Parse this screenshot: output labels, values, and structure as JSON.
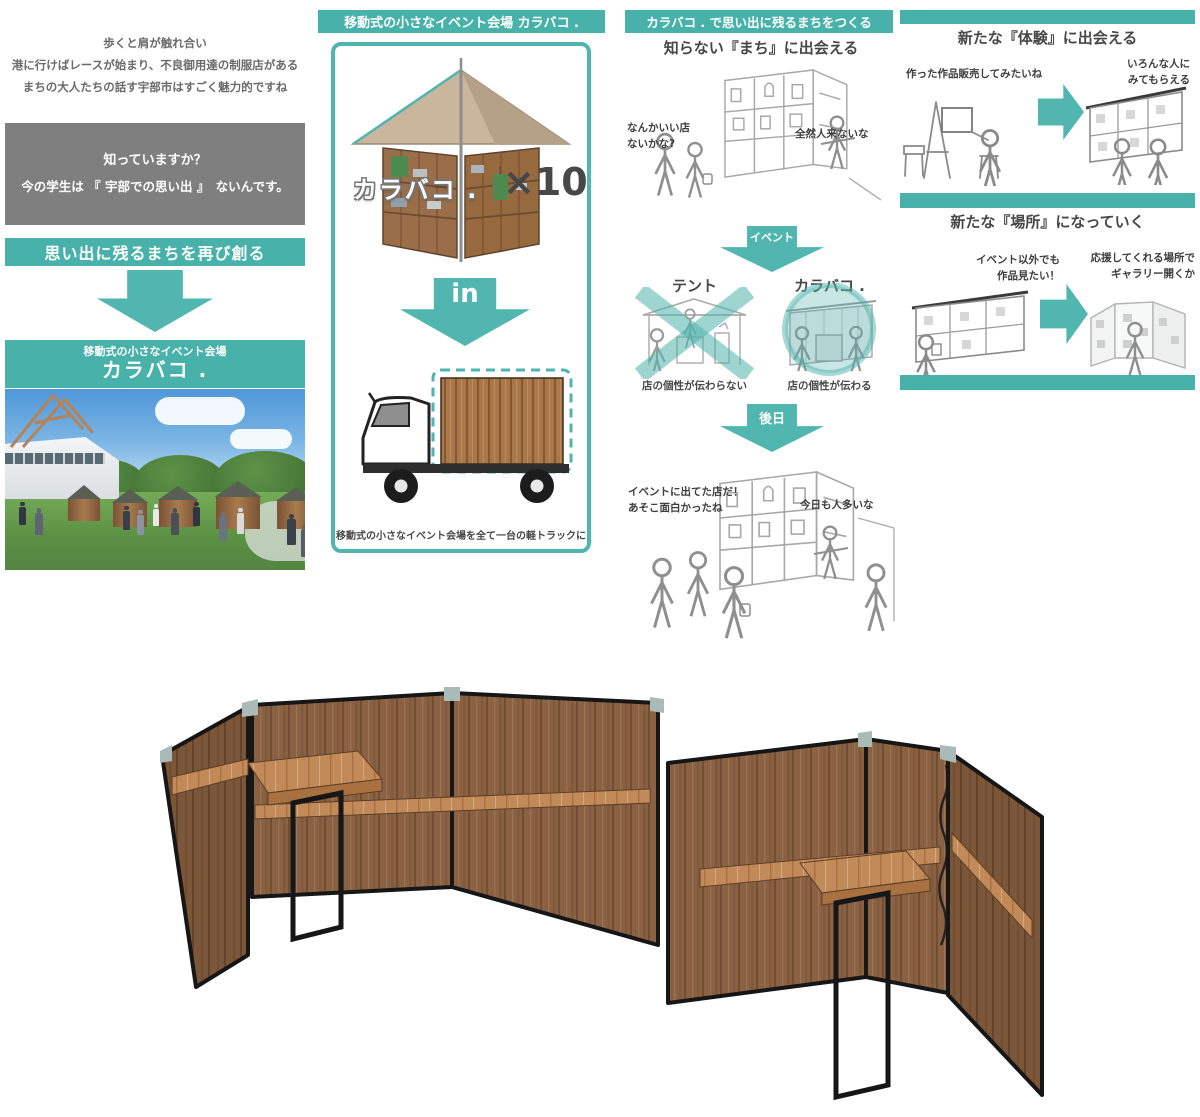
{
  "colors": {
    "teal_bar": "#47b1aa",
    "teal_arrow": "#50b6af",
    "gray_panel": "#7f7f7f",
    "text_dark": "#4d4d4d",
    "wood_panel": "#8a6243",
    "wood_shelf": "#c28a59",
    "frame_black": "#161616"
  },
  "col1": {
    "intro": [
      "歩くと肩が触れ合い",
      "港に行けばレースが始まり、不良御用達の制服店がある",
      "まちの大人たちの話す宇部市はすごく魅力的ですね"
    ],
    "gray_box": [
      "知っていますか？",
      "今の学生は 『 宇部での思い出 』　ないんです。"
    ],
    "banner_remake": "思い出に残るまちを再び創る",
    "product_tag": "移動式の小さなイベント会場",
    "product_name": "カラバコ ."
  },
  "col2": {
    "header": "移動式の小さなイベント会場  カラバコ .",
    "kiosk_label": "カラバコ .",
    "multiplier": "×10",
    "in_label": "in",
    "caption": "移動式の小さなイベント会場を全て一台の軽トラックに"
  },
  "col3": {
    "header": "カラバコ . で思い出に残るまちをつくる",
    "subtitle": "知らない『まち』に出会える",
    "bubble_want_shop": "なんかいい店\nないかな?",
    "bubble_no_visitors": "全然人来ないな",
    "arrow_event": "イベント",
    "tent_label": "テント",
    "karabako_label": "カラバコ .",
    "tent_caption": "店の個性が伝わらない",
    "karabako_caption": "店の個性が伝わる",
    "arrow_later": "後日",
    "bubble_remember": "イベントに出てた店だ！\nあそこ面白かったね",
    "bubble_crowded": "今日も人多いな"
  },
  "col4": {
    "title_experience": "新たな『体験』に出会える",
    "bubble_sell": "作った作品販売してみたいね",
    "bubble_seen": "いろんな人に\nみてもらえる",
    "title_place": "新たな『場所』になっていく",
    "bubble_outside_event": "イベント以外でも\n作品見たい！",
    "bubble_gallery": "応援してくれる場所で\nギャラリー開くか"
  }
}
